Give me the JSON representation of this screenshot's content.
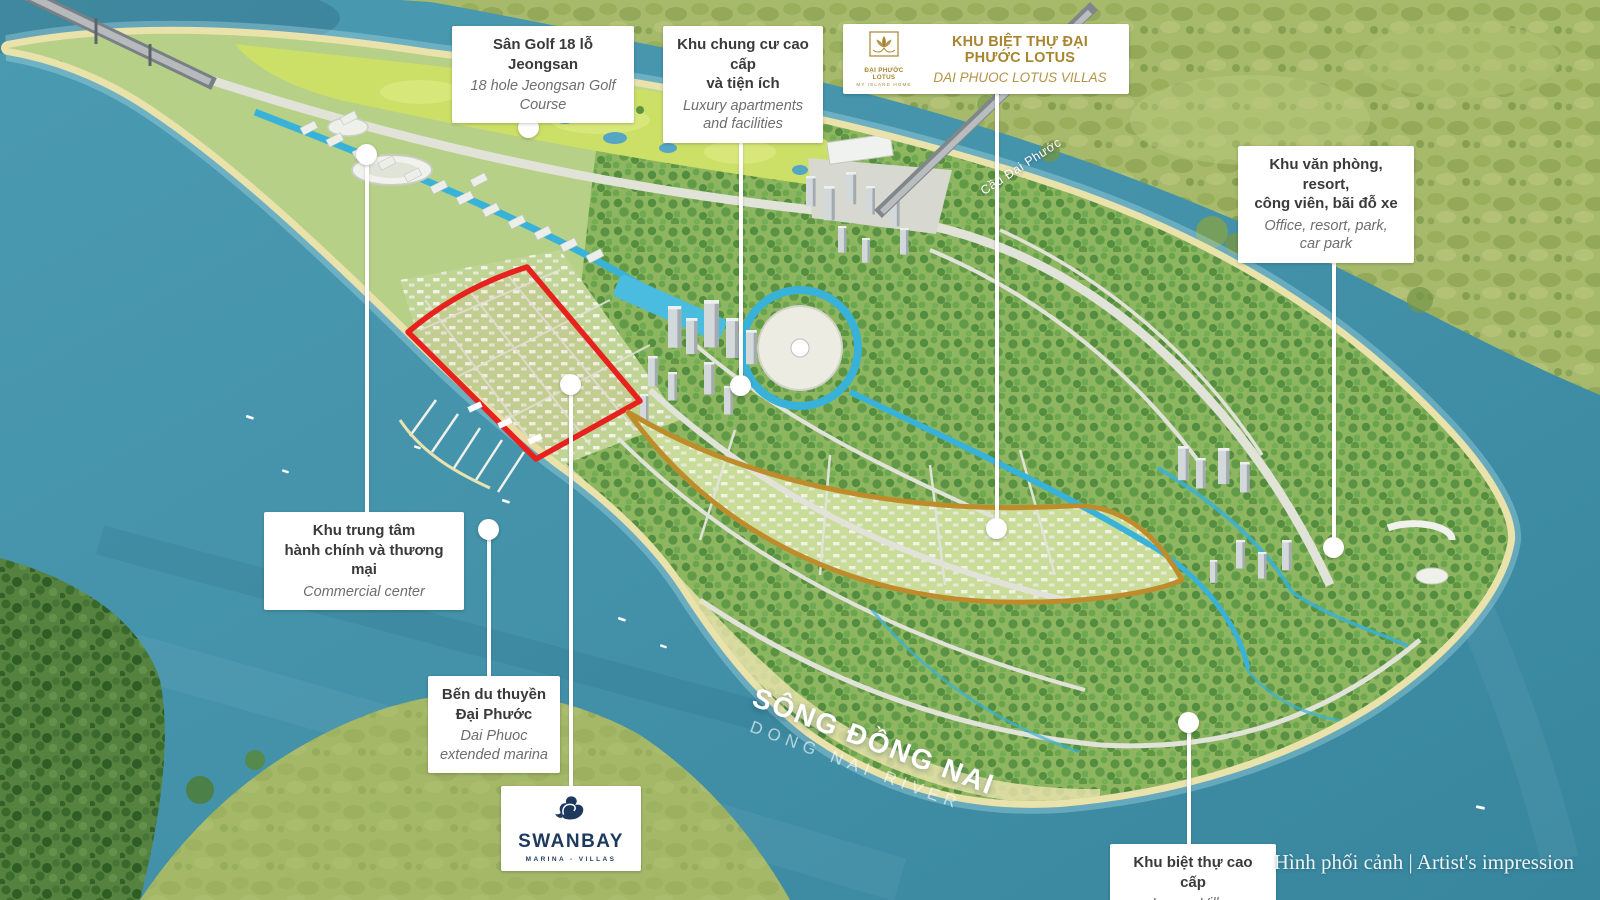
{
  "colors": {
    "red_zone": "#e7211d",
    "gold_zone": "#bf8c2c",
    "gold_text": "#a8842f",
    "navy": "#1d3a5e"
  },
  "labels": {
    "golf": {
      "vi": "Sân Golf 18 lỗ Jeongsan",
      "en": "18 hole Jeongsan Golf Course"
    },
    "apartments": {
      "vi": "Khu chung cư cao cấp\nvà tiện ích",
      "en": "Luxury apartments\nand facilities"
    },
    "lotus": {
      "title": "KHU BIỆT THỰ ĐẠI PHƯỚC LOTUS",
      "subtitle": "DAI PHUOC LOTUS VILLAS",
      "logo_name": "ĐẠI PHƯỚC LOTUS",
      "logo_tagline": "MY ISLAND HOME"
    },
    "office": {
      "vi": "Khu văn phòng, resort,\ncông viên, bãi đỗ xe",
      "en": "Office, resort, park,\ncar park"
    },
    "commercial": {
      "vi": "Khu trung tâm\nhành chính và thương mại",
      "en": "Commercial center"
    },
    "marina": {
      "vi": "Bến du thuyền\nĐại Phước",
      "en": "Dai Phuoc\nextended marina"
    },
    "luxury": {
      "vi": "Khu biệt thự cao cấp",
      "en": "Luxury Villas"
    }
  },
  "swanbay": {
    "name": "SWANBAY",
    "tagline": "MARINA - VILLAS"
  },
  "river": {
    "vi": "SÔNG ĐỒNG NAI",
    "en": "DONG NAI RIVER"
  },
  "bridge_label": "Cầu Đại Phước",
  "caption": "Hình phối cảnh | Artist's impression"
}
